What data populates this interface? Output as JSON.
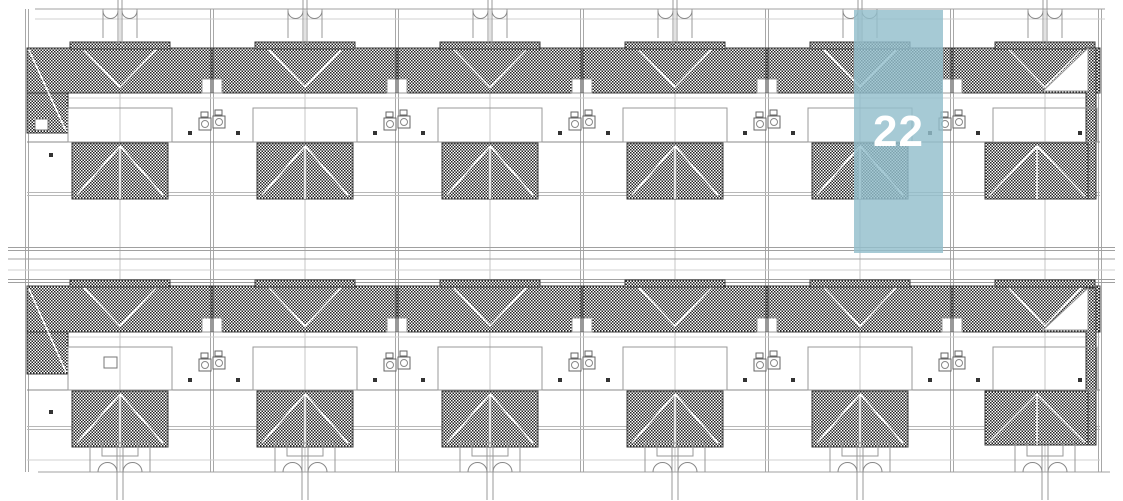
{
  "plan": {
    "view": "roof plan of two rows of terraced houses",
    "rows": 2,
    "duplex_blocks_per_row": 6,
    "hatch_color": "#222222",
    "line_color": "#9a9a9a",
    "roof_outline_color": "#3c3c3c"
  },
  "highlight": {
    "unit_number": "22",
    "fill_color": "rgba(146,190,204,0.82)",
    "label_color": "#ffffff"
  }
}
